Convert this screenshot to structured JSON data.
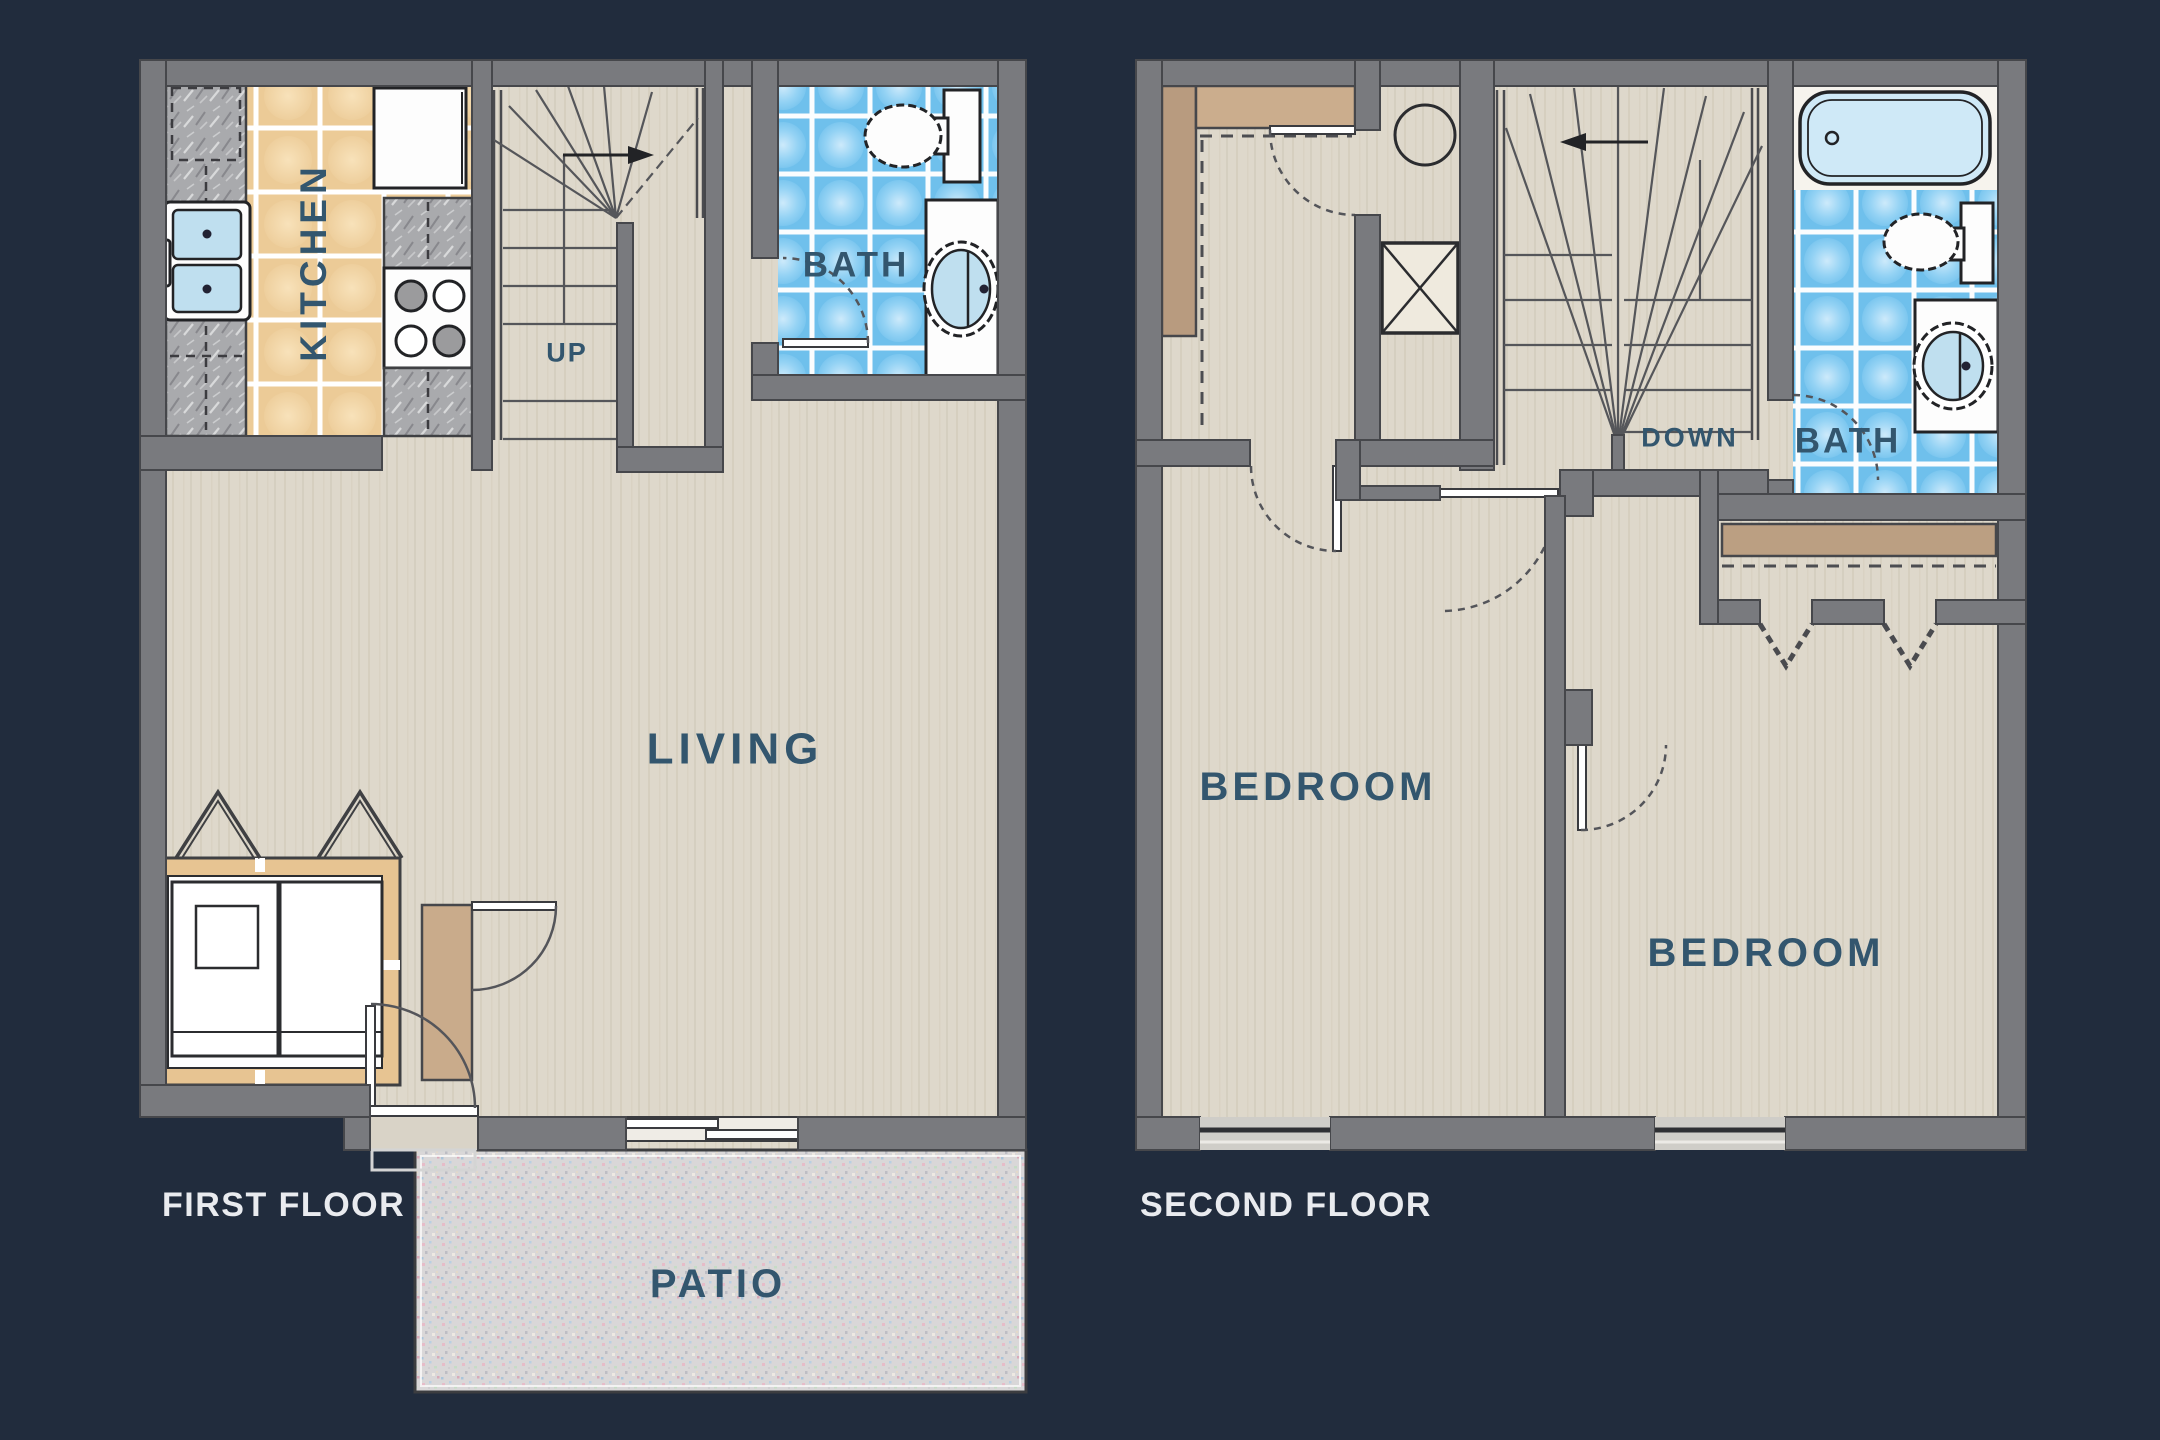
{
  "diagram_type": "apartment floor plan, two-story townhouse unit",
  "first_floor": {
    "title": "FIRST FLOOR",
    "kitchen_label": "KITCHEN",
    "bath_label": "BATH",
    "living_label": "LIVING",
    "patio_label": "PATIO",
    "stair_direction_label": "UP"
  },
  "second_floor": {
    "title": "SECOND FLOOR",
    "bedroom1_label": "BEDROOM",
    "bedroom2_label": "BEDROOM",
    "bath_label": "BATH",
    "stair_direction_label": "DOWN"
  },
  "colors": {
    "background": "#212c3d",
    "wall": "#797a7e",
    "floor": "#ded8cb",
    "kitchen_tile": "#eccb97",
    "bath_tile": "#6fc0ec",
    "bathtub": "#cfe9f7",
    "counter": "#a9aaad",
    "shelf_tan": "#c9ab8b",
    "patio": "#d9d7d8",
    "room_label": "#33566e",
    "floor_title": "#e9ebef"
  }
}
